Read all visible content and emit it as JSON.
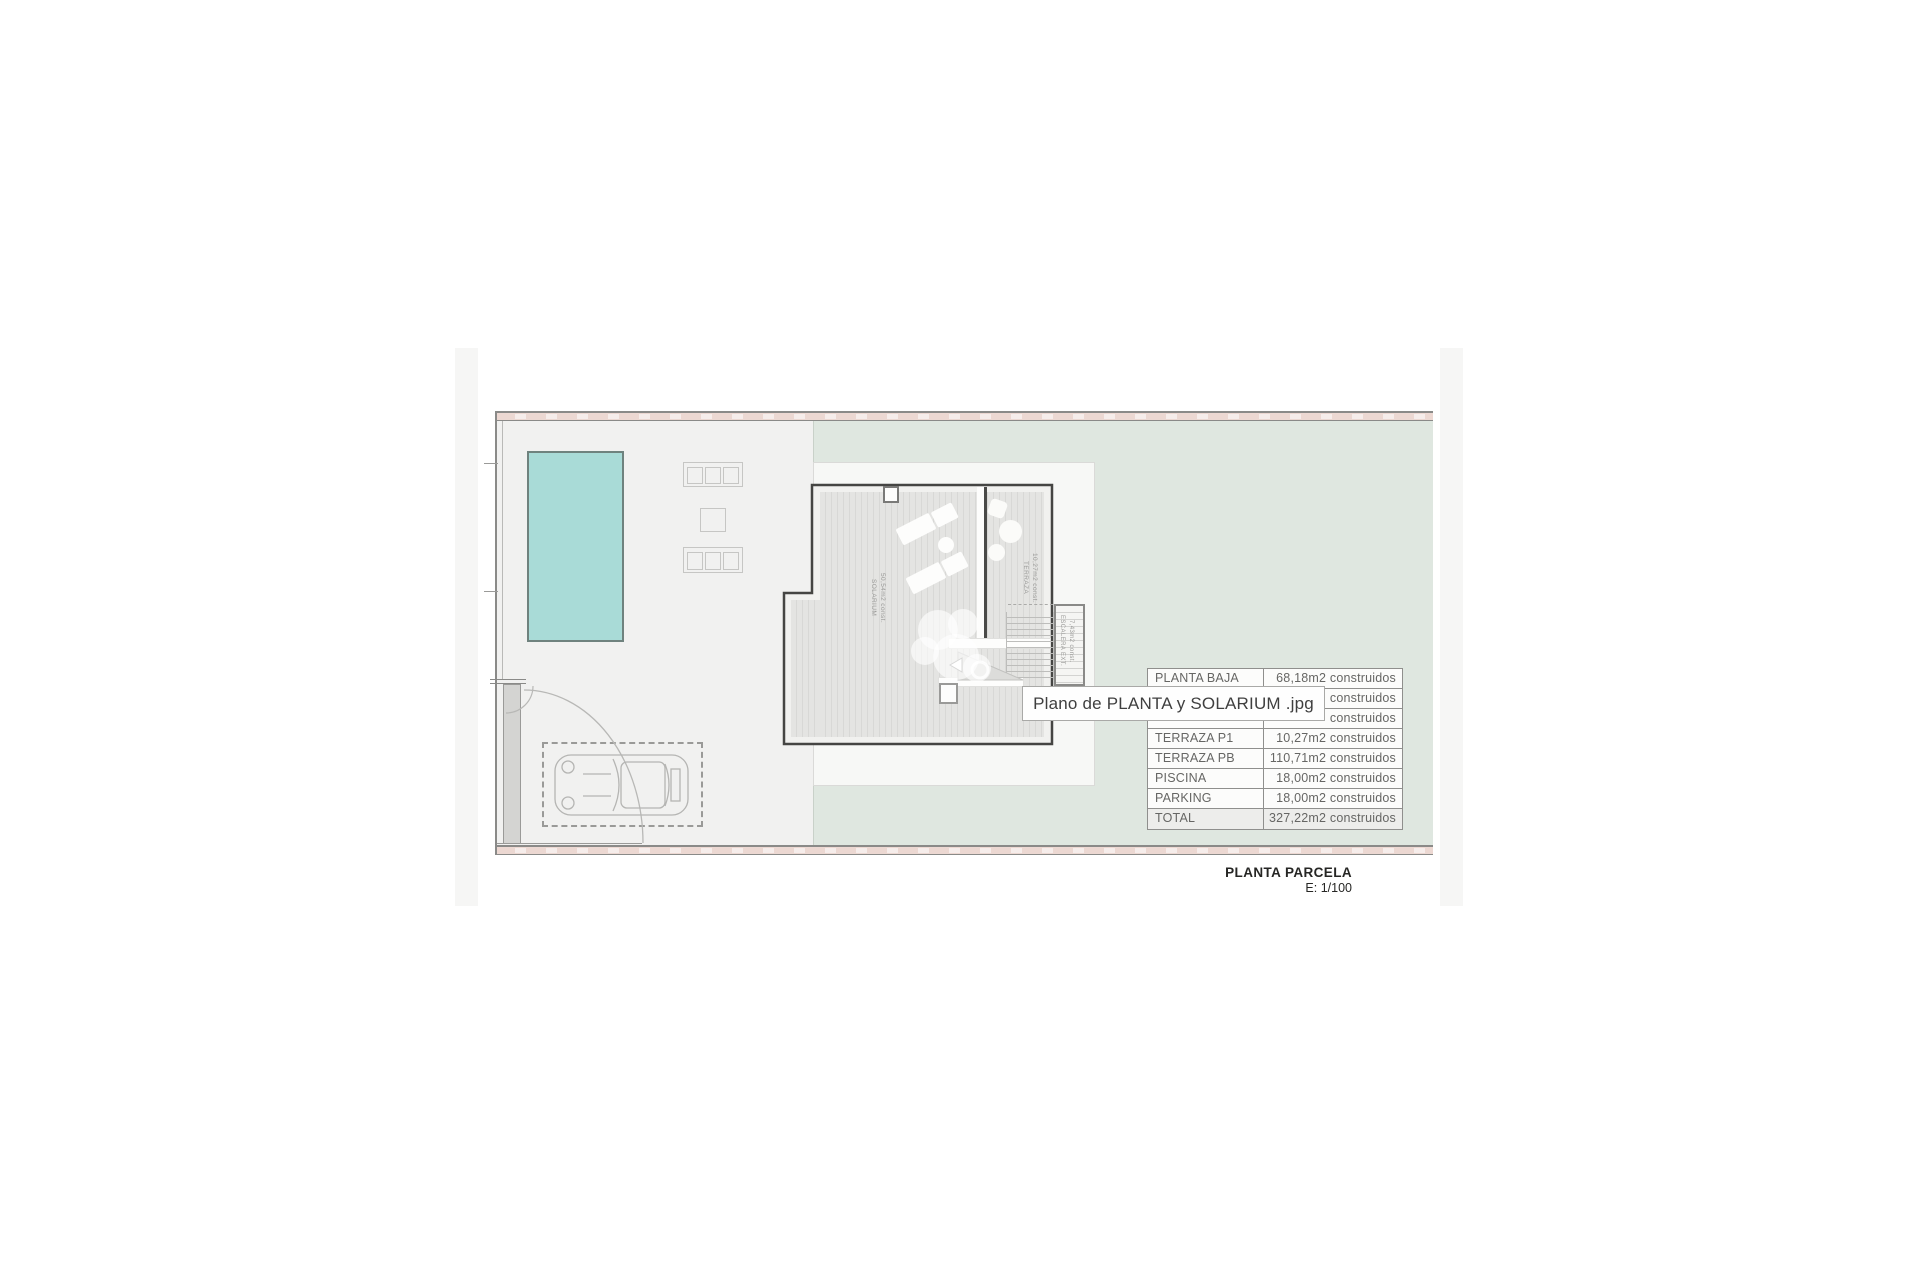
{
  "caption": {
    "title": "PLANTA PARCELA",
    "scale": "E: 1/100"
  },
  "tooltip": {
    "filename": "Plano de PLANTA y SOLARIUM .jpg"
  },
  "areas_table": {
    "rows": [
      {
        "label": "PLANTA BAJA",
        "value": "68,18m2 construidos"
      },
      {
        "label": "",
        "value": "construidos"
      },
      {
        "label": "",
        "value": "construidos"
      },
      {
        "label": "TERRAZA P1",
        "value": "10,27m2 construidos"
      },
      {
        "label": "TERRAZA PB",
        "value": "110,71m2 construidos"
      },
      {
        "label": "PISCINA",
        "value": "18,00m2 construidos"
      },
      {
        "label": "PARKING",
        "value": "18,00m2 construidos"
      },
      {
        "label": "TOTAL",
        "value": "327,22m2 construidos"
      }
    ]
  },
  "plan": {
    "labels": {
      "solarium": {
        "name": "SOLARIUM",
        "area": "50,54m2 const."
      },
      "terraza": {
        "name": "TERRAZA",
        "area": "10,27m2 const."
      },
      "escalera": {
        "name": "ESCALERA EXT.",
        "area": "7,43m2 const."
      }
    },
    "colors": {
      "pool": "#a9dbd7",
      "lawn": "#dfe7e0",
      "paving": "#f1f1f0",
      "fence_band": "#ecd8d2",
      "house_outline": "#454543"
    }
  }
}
